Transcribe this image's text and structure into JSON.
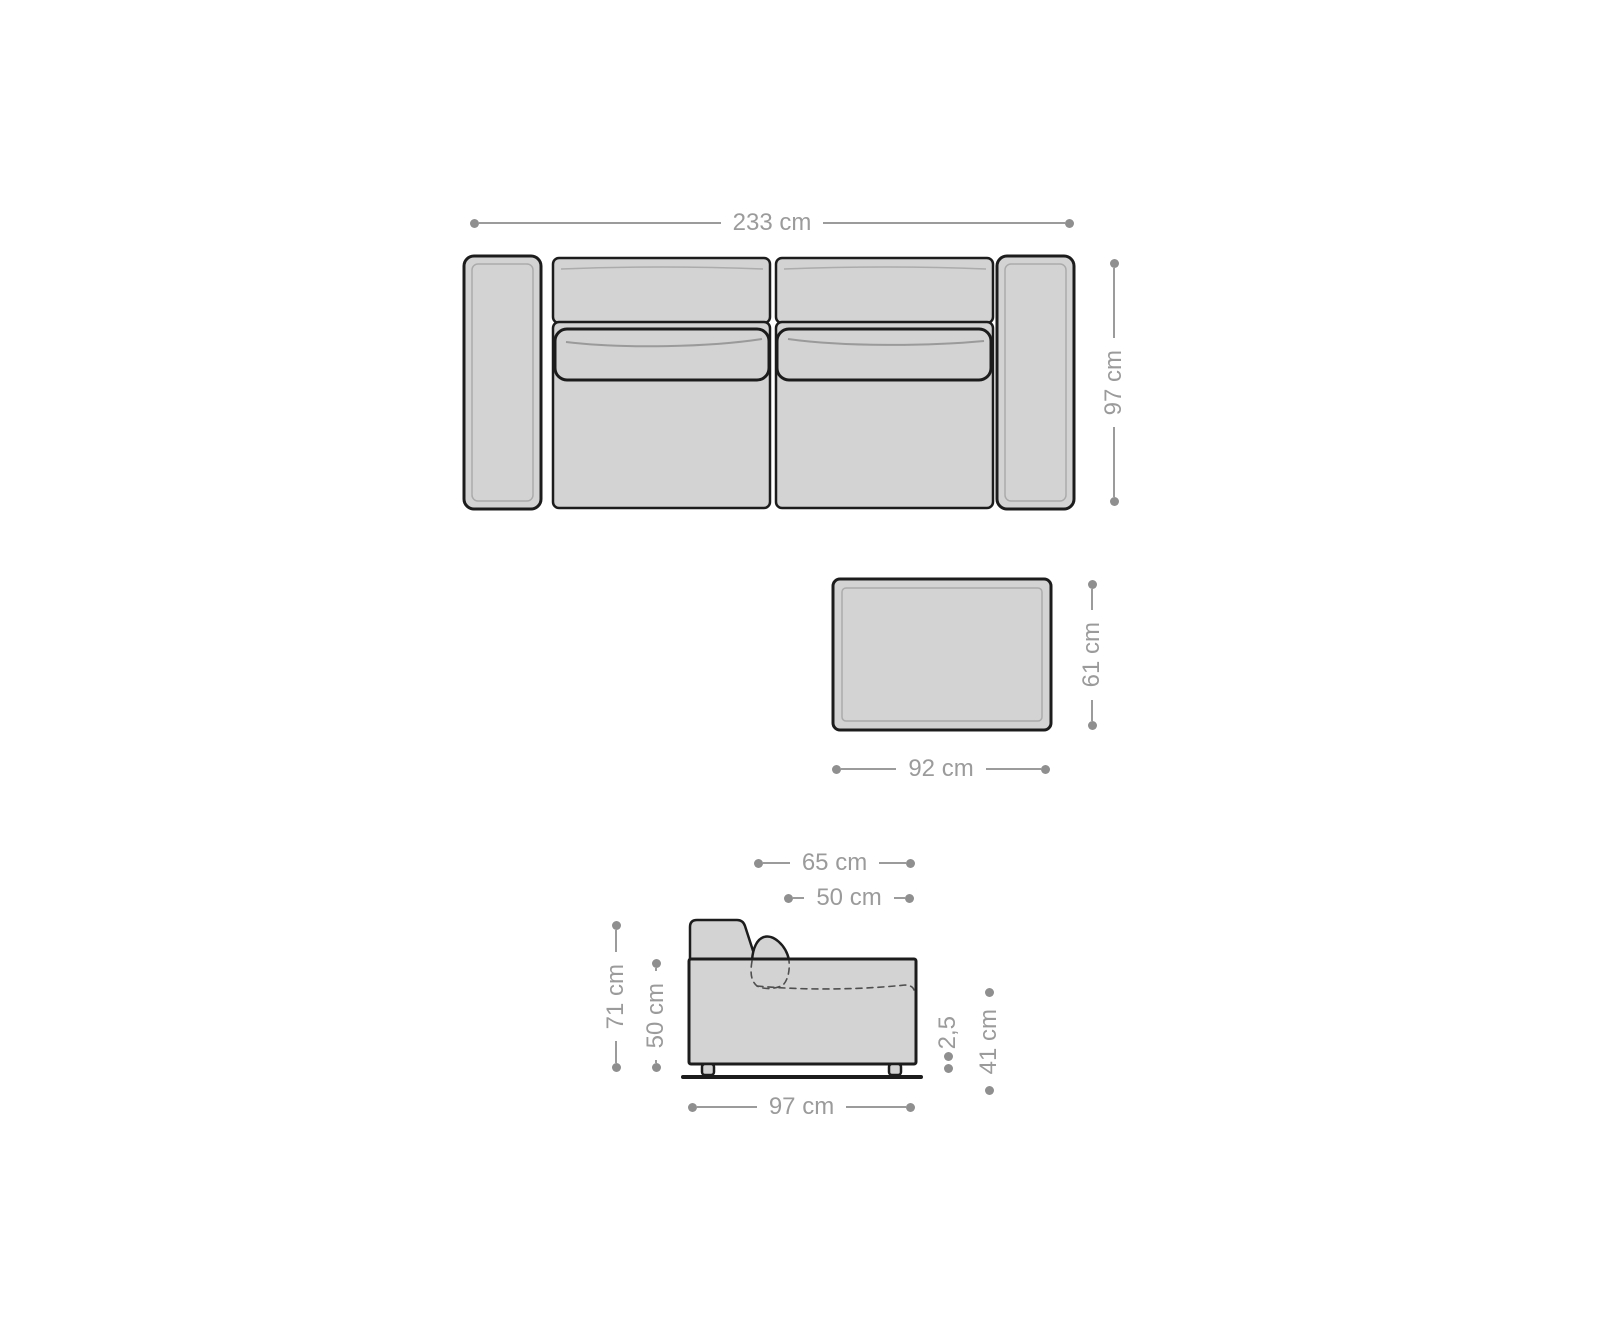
{
  "colors": {
    "background": "#ffffff",
    "furniture_fill": "#d3d3d3",
    "outline": "#1c1c1c",
    "dimension": "#9b9b9b",
    "dot": "#8f8f8f"
  },
  "dimensions": {
    "sofa_width": "233 cm",
    "sofa_depth": "97 cm",
    "ottoman_depth": "61 cm",
    "ottoman_width": "92 cm",
    "seat_depth_outer": "65 cm",
    "seat_depth": "50 cm",
    "total_height": "71 cm",
    "body_height": "50 cm",
    "leg_height": "2,5",
    "seat_height": "41 cm",
    "side_depth": "97 cm"
  }
}
